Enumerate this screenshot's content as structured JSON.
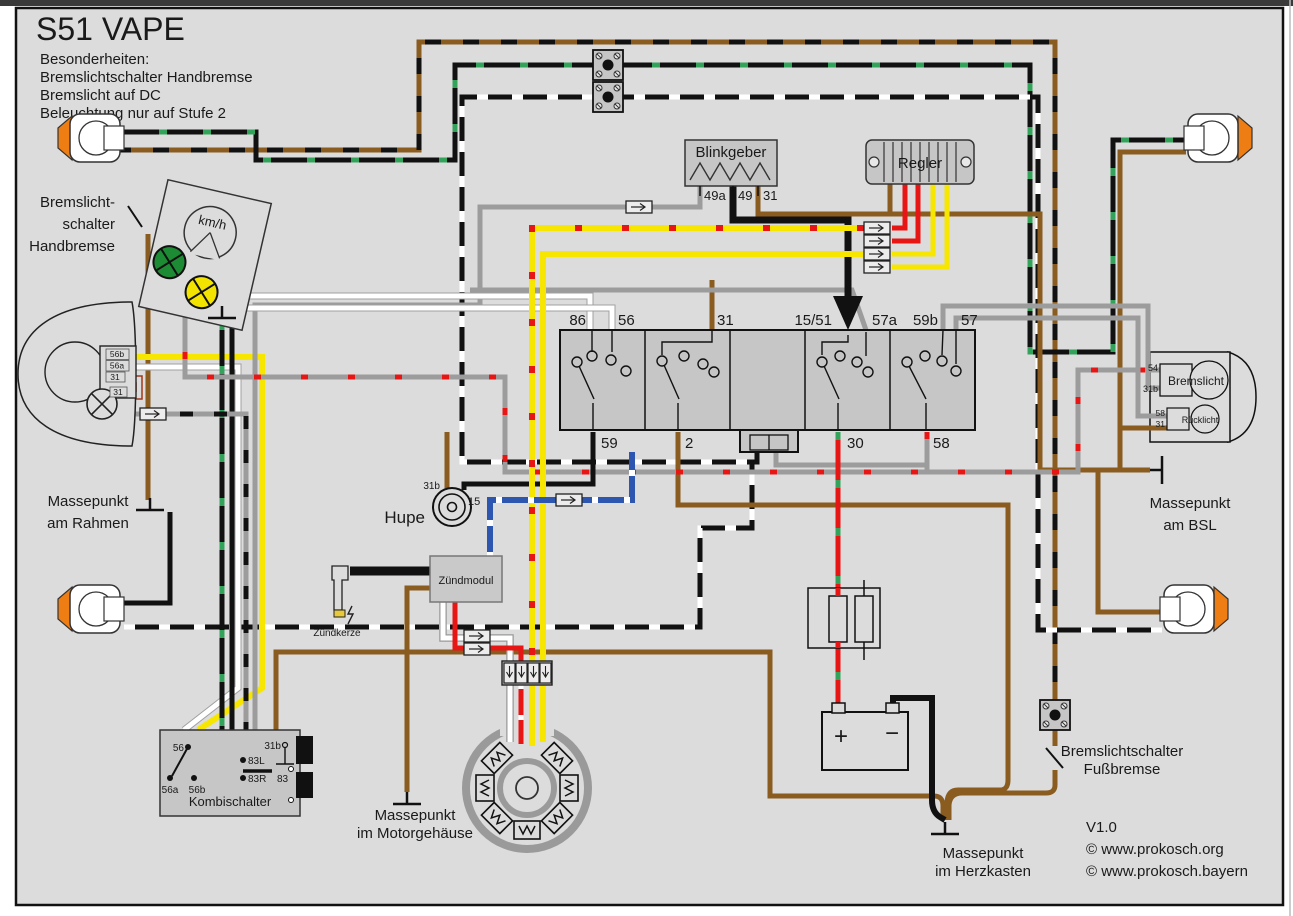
{
  "title": "S51 VAPE",
  "notes": [
    "Besonderheiten:",
    "Bremslichtschalter Handbremse",
    "Bremslicht auf DC",
    "Beleuchtung nur auf Stufe 2"
  ],
  "labels": {
    "handbrake_switch": [
      "Bremslicht-",
      "schalter",
      "Handbremse"
    ],
    "footbrake_switch": [
      "Bremslichtschalter",
      "Fußbremse"
    ],
    "ground_frame": [
      "Massepunkt",
      "am Rahmen"
    ],
    "ground_engine": [
      "Massepunkt",
      "im Motorgehäuse"
    ],
    "ground_heart": [
      "Massepunkt",
      "im Herzkasten"
    ],
    "ground_bsl": [
      "Massepunkt",
      "am BSL"
    ],
    "horn": "Hupe",
    "speedo_unit": "km/h",
    "combi_switch": "Kombischalter",
    "flasher": "Blinkgeber",
    "regulator": "Regler",
    "ignition_module": "Zündmodul",
    "spark_plug": "Zündkerze",
    "brake_light": "Bremslicht",
    "tail_light": "Rücklicht"
  },
  "terminals": {
    "switch_block_top": [
      "86",
      "56",
      "31",
      "15/51",
      "57a",
      "59b",
      "57"
    ],
    "switch_block_bottom": [
      "59",
      "2",
      "30",
      "58"
    ],
    "flasher": [
      "49a",
      "49",
      "31"
    ],
    "horn": [
      "31b",
      "15"
    ],
    "headlight": [
      "56b",
      "56a",
      "31",
      "31"
    ],
    "combi": [
      "56",
      "56a",
      "56b",
      "83L",
      "83R",
      "83",
      "31b"
    ],
    "brake_light": [
      "54",
      "31b"
    ],
    "tail_light": [
      "58",
      "31"
    ],
    "battery_plus": "+",
    "battery_minus": "−"
  },
  "footer": {
    "version": "V1.0",
    "copy1": "© www.prokosch.org",
    "copy2": "© www.prokosch.bayern"
  },
  "colors": {
    "bg": "#dcdcdc",
    "box": "#c6c6c6",
    "brown": "#8a5c20",
    "black": "#111111",
    "yellow": "#f6e600",
    "red": "#e81515",
    "green": "#33a35c",
    "grey": "#9c9c9c",
    "blue": "#2d56b0",
    "lens_orange": "#ee7d13",
    "lens_red": "#e31219",
    "lamp_green": "#1d8a34",
    "lamp_yellow": "#f2e300"
  }
}
